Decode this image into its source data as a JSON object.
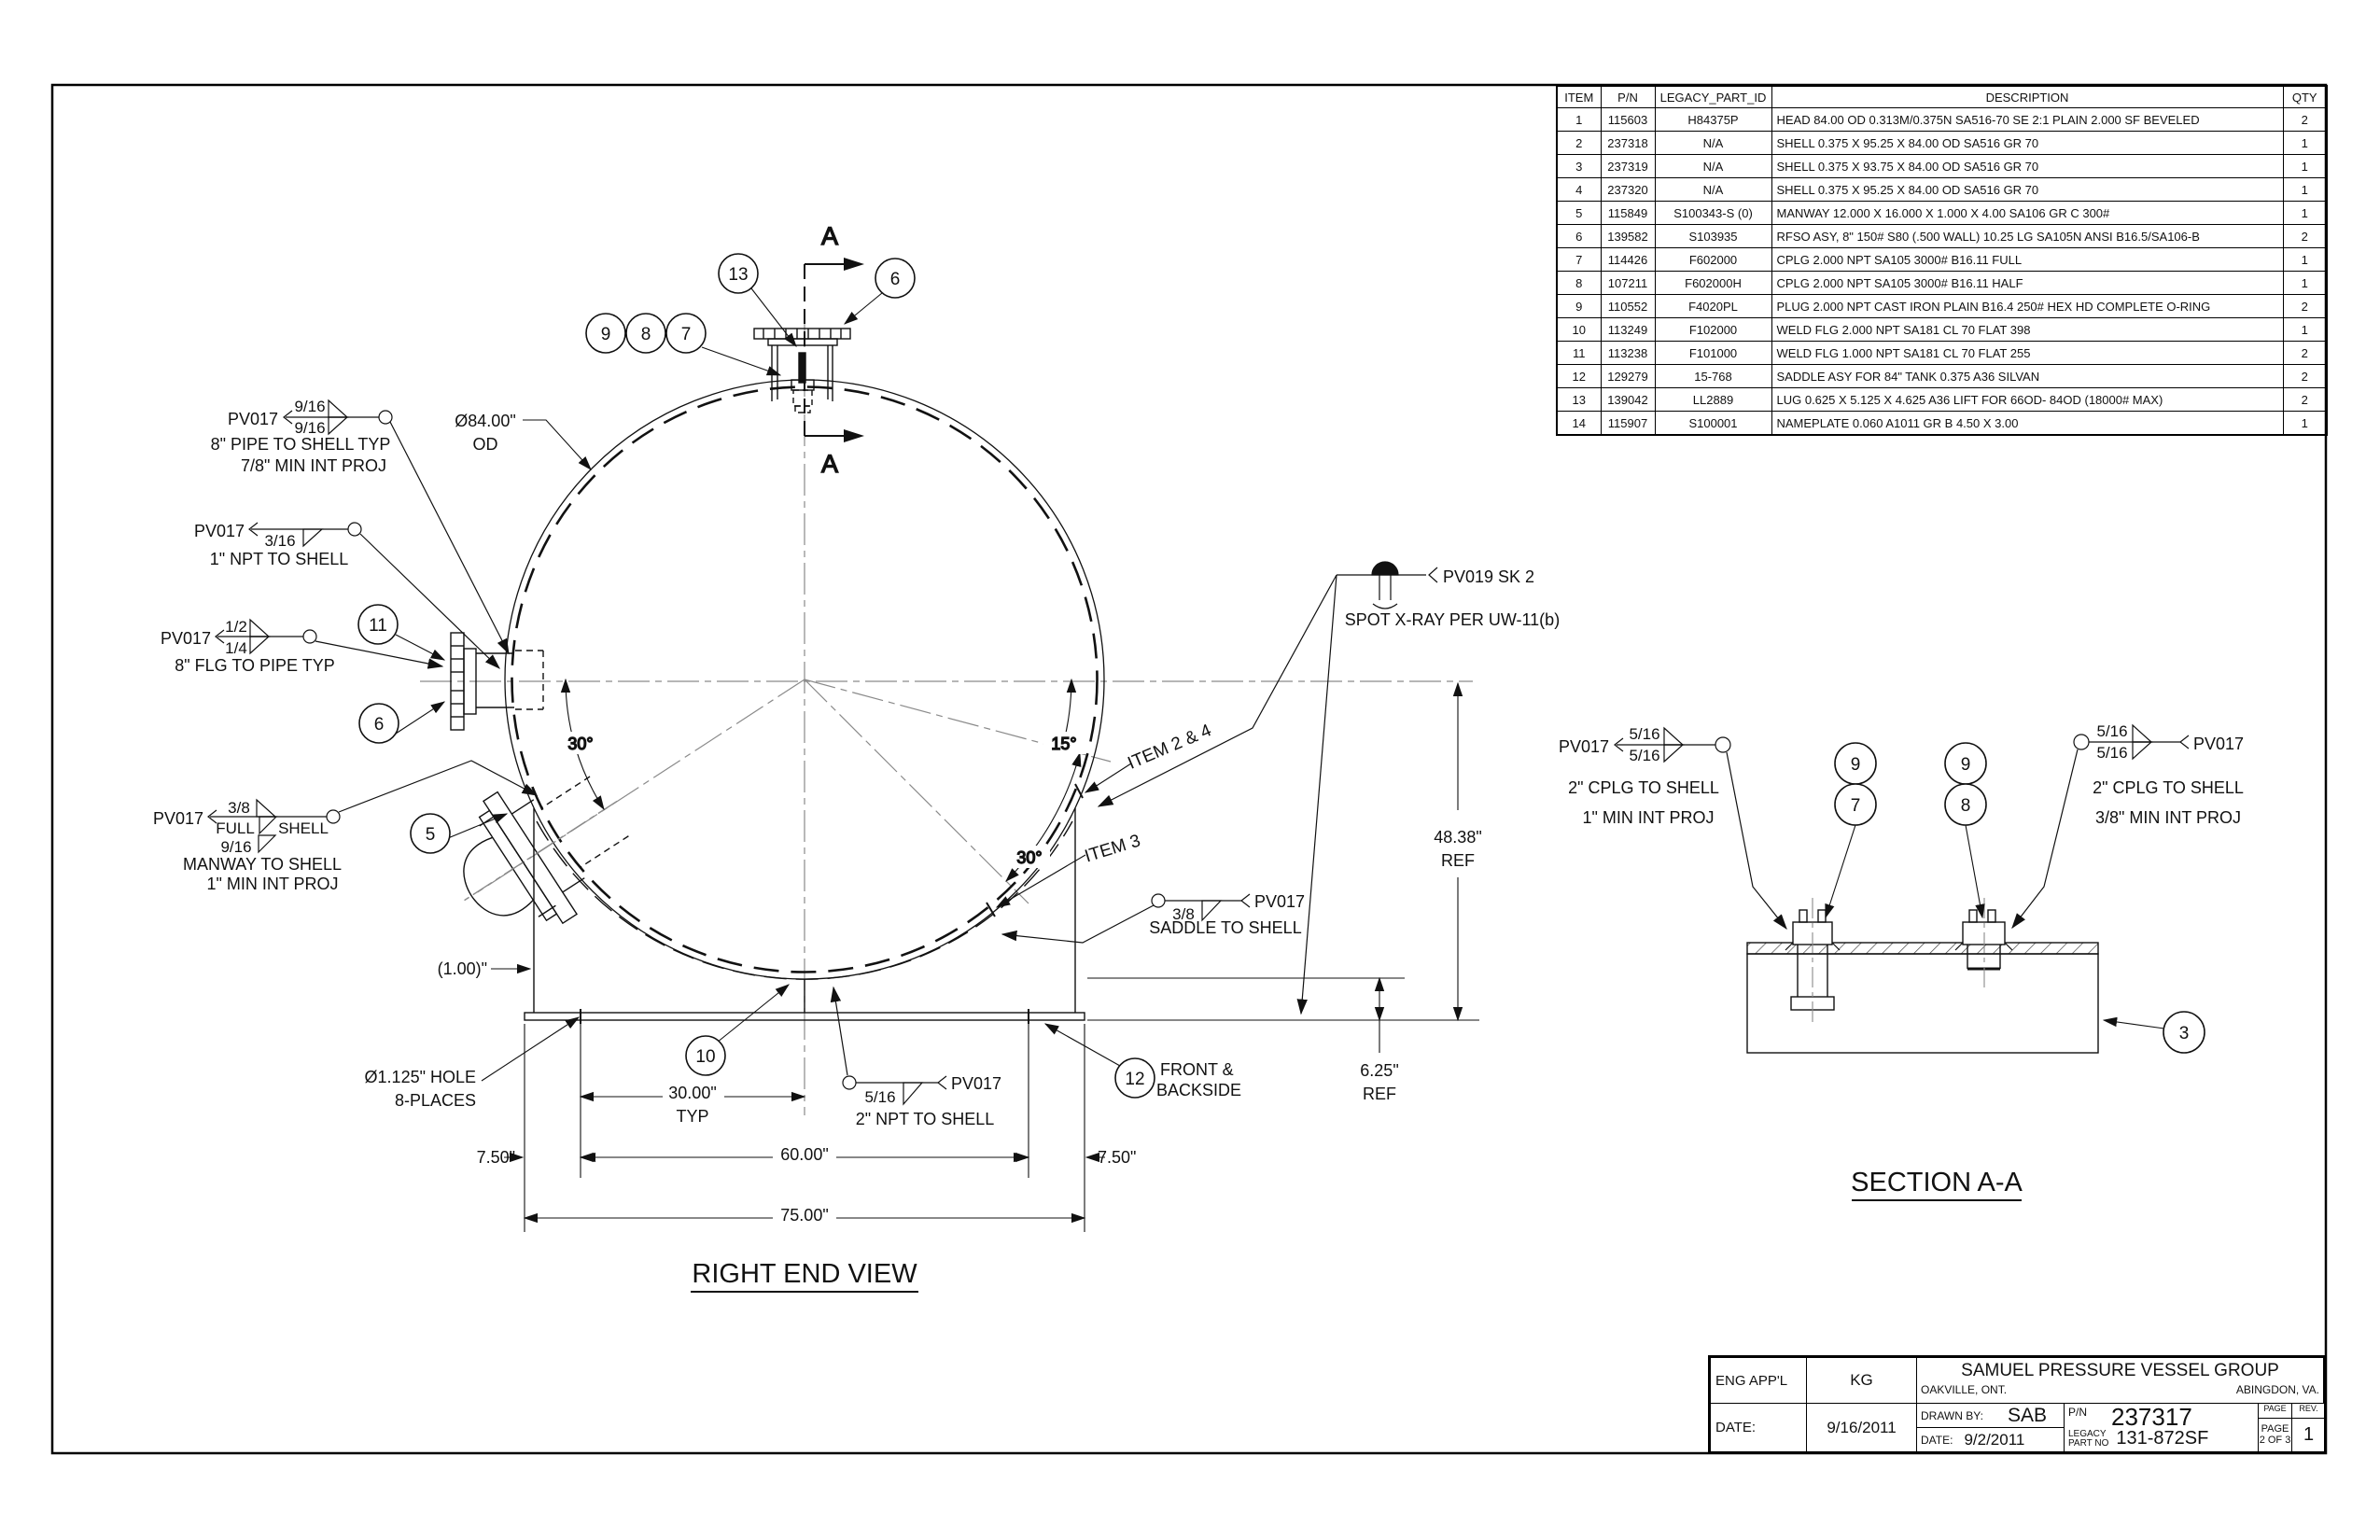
{
  "bom": {
    "headers": [
      "ITEM",
      "P/N",
      "LEGACY_PART_ID",
      "DESCRIPTION",
      "QTY"
    ],
    "rows": [
      [
        "1",
        "115603",
        "H84375P",
        "HEAD 84.00 OD 0.313M/0.375N SA516-70 SE 2:1 PLAIN 2.000 SF BEVELED",
        "2"
      ],
      [
        "2",
        "237318",
        "N/A",
        "SHELL 0.375 X 95.25 X 84.00 OD SA516 GR 70",
        "1"
      ],
      [
        "3",
        "237319",
        "N/A",
        "SHELL 0.375 X 93.75 X 84.00 OD SA516 GR 70",
        "1"
      ],
      [
        "4",
        "237320",
        "N/A",
        "SHELL 0.375 X 95.25 X 84.00 OD SA516 GR 70",
        "1"
      ],
      [
        "5",
        "115849",
        "S100343-S (0)",
        "MANWAY 12.000 X 16.000 X 1.000 X 4.00 SA106 GR C 300#",
        "1"
      ],
      [
        "6",
        "139582",
        "S103935",
        "RFSO ASY, 8\" 150# S80 (.500 WALL) 10.25 LG SA105N ANSI B16.5/SA106-B",
        "2"
      ],
      [
        "7",
        "114426",
        "F602000",
        "CPLG 2.000 NPT SA105 3000# B16.11 FULL",
        "1"
      ],
      [
        "8",
        "107211",
        "F602000H",
        "CPLG 2.000 NPT SA105 3000# B16.11 HALF",
        "1"
      ],
      [
        "9",
        "110552",
        "F4020PL",
        "PLUG 2.000 NPT CAST IRON PLAIN B16.4 250# HEX HD COMPLETE O-RING",
        "2"
      ],
      [
        "10",
        "113249",
        "F102000",
        "WELD FLG 2.000 NPT SA181 CL 70 FLAT 398",
        "1"
      ],
      [
        "11",
        "113238",
        "F101000",
        "WELD FLG 1.000  NPT SA181 CL 70 FLAT 255",
        "2"
      ],
      [
        "12",
        "129279",
        "15-768",
        "SADDLE ASY FOR 84\" TANK 0.375 A36 SILVAN",
        "2"
      ],
      [
        "13",
        "139042",
        "LL2889",
        "LUG 0.625 X 5.125 X 4.625 A36 LIFT FOR 66OD- 84OD (18000# MAX)",
        "2"
      ],
      [
        "14",
        "115907",
        "S100001",
        "NAMEPLATE 0.060 A1011 GR B 4.50 X 3.00",
        "1"
      ]
    ]
  },
  "title_block": {
    "eng_appl_label": "ENG APP'L",
    "eng_appl_value": "KG",
    "date_label": "DATE:",
    "date_value": "9/16/2011",
    "company": "SAMUEL PRESSURE VESSEL GROUP",
    "office_left": "OAKVILLE, ONT.",
    "office_right": "ABINGDON, VA.",
    "drawn_by_label": "DRAWN BY:",
    "drawn_by_value": "SAB",
    "drawn_date_label": "DATE:",
    "drawn_date_value": "9/2/2011",
    "pn_label": "P/N",
    "pn_value": "237317",
    "legacy_label_1": "LEGACY",
    "legacy_label_2": "PART NO",
    "legacy_value": "131-872SF",
    "page_header": "PAGE",
    "page_value_1": "PAGE",
    "page_value_2": "2 OF 3",
    "rev_header": "REV.",
    "rev_value": "1"
  },
  "views": {
    "right_end": "RIGHT END VIEW",
    "section": "SECTION A-A"
  },
  "balloons": [
    "9",
    "8",
    "7",
    "13",
    "6",
    "11",
    "6",
    "5",
    "10",
    "12",
    "9",
    "7",
    "9",
    "8",
    "3"
  ],
  "section_letter": "A",
  "dims": {
    "od": "Ø84.00\"",
    "od2": "OD",
    "d30": "30.00\"",
    "typ": "TYP",
    "d60": "60.00\"",
    "d75": "75.00\"",
    "d750l": "7.50\"",
    "d750r": "7.50\"",
    "d4838": "48.38\"",
    "ref1": "REF",
    "d625": "6.25\"",
    "ref2": "REF",
    "hole1": "Ø1.125\" HOLE",
    "hole2": "8-PLACES",
    "paren100": "(1.00)\"",
    "a15": "15°",
    "a30r": "30°",
    "a30l": "30°"
  },
  "labels": {
    "item24": "ITEM 2 & 4",
    "item3": "ITEM 3",
    "front1": "FRONT &",
    "front2": "BACKSIDE",
    "xray_tag": "PV019 SK 2",
    "xray_note": "SPOT X-RAY PER UW-11(b)"
  },
  "welds": {
    "pipe_shell": {
      "tag": "PV017",
      "s1": "9/16",
      "s2": "9/16",
      "l1": "8\" PIPE TO SHELL TYP",
      "l2": "7/8\" MIN INT PROJ"
    },
    "npt1": {
      "tag": "PV017",
      "s1": "3/16",
      "l1": "1\" NPT TO SHELL"
    },
    "flg_pipe": {
      "tag": "PV017",
      "s1": "1/2",
      "s2": "1/4",
      "l1": "8\" FLG TO PIPE TYP"
    },
    "manway": {
      "tag": "PV017",
      "s1": "3/8",
      "s2": "FULL",
      "s3": "SHELL",
      "s4": "9/16",
      "l1": "MANWAY TO SHELL",
      "l2": "1\" MIN INT PROJ"
    },
    "npt2": {
      "tag": "PV017",
      "s1": "5/16",
      "l1": "2\" NPT TO SHELL"
    },
    "saddle": {
      "tag": "PV017",
      "s1": "3/8",
      "l1": "SADDLE TO SHELL"
    },
    "cplg_left": {
      "tag": "PV017",
      "s1": "5/16",
      "s2": "5/16",
      "l1": "2\" CPLG TO SHELL",
      "l2": "1\" MIN INT PROJ"
    },
    "cplg_right": {
      "tag": "PV017",
      "s1": "5/16",
      "s2": "5/16",
      "l1": "2\" CPLG TO SHELL",
      "l2": "3/8\" MIN INT PROJ"
    }
  }
}
